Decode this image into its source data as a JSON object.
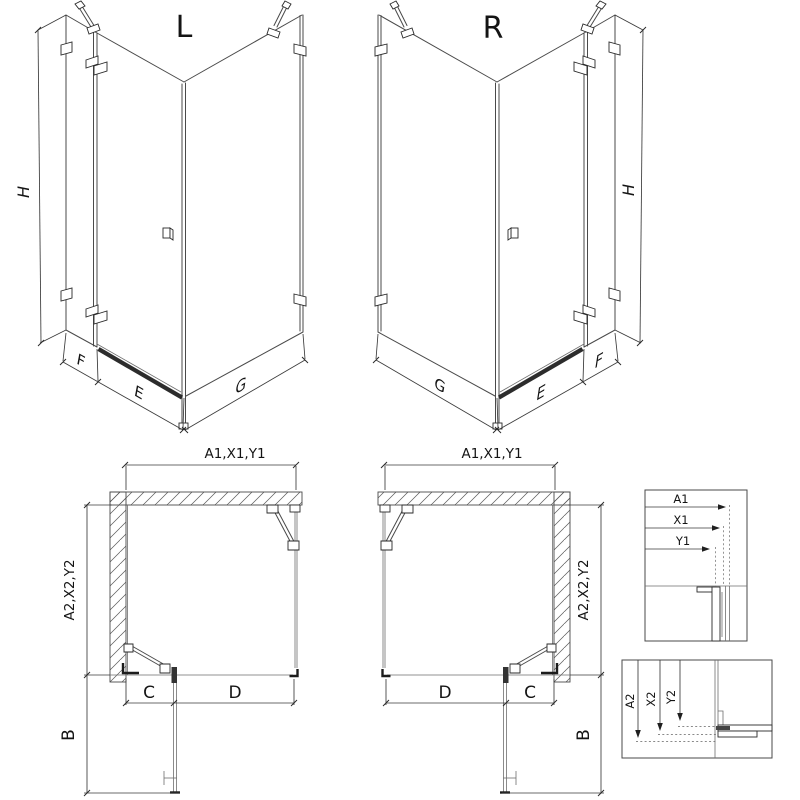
{
  "drawing": {
    "iso_left": {
      "variant": "L",
      "dim_h": "H",
      "dim_f": "F",
      "dim_e": "E",
      "dim_g": "G"
    },
    "iso_right": {
      "variant": "R",
      "dim_h": "H",
      "dim_f": "F",
      "dim_e": "E",
      "dim_g": "G"
    },
    "plan_left": {
      "dim_top": "A1,X1,Y1",
      "dim_side": "A2,X2,Y2",
      "dim_b": "B",
      "dim_c": "C",
      "dim_d": "D"
    },
    "plan_right": {
      "dim_top": "A1,X1,Y1",
      "dim_side": "A2,X2,Y2",
      "dim_b": "B",
      "dim_c": "C",
      "dim_d": "D"
    },
    "detail_top": {
      "dim_a1": "A1",
      "dim_x1": "X1",
      "dim_y1": "Y1"
    },
    "detail_bottom": {
      "dim_a2": "A2",
      "dim_x2": "X2",
      "dim_y2": "Y2"
    },
    "colors": {
      "line": "#4a4a4a",
      "line_light": "#6e6e6e",
      "hardware": "#1c1c1c",
      "dotted": "#8a8a8a",
      "background": "#ffffff"
    }
  }
}
